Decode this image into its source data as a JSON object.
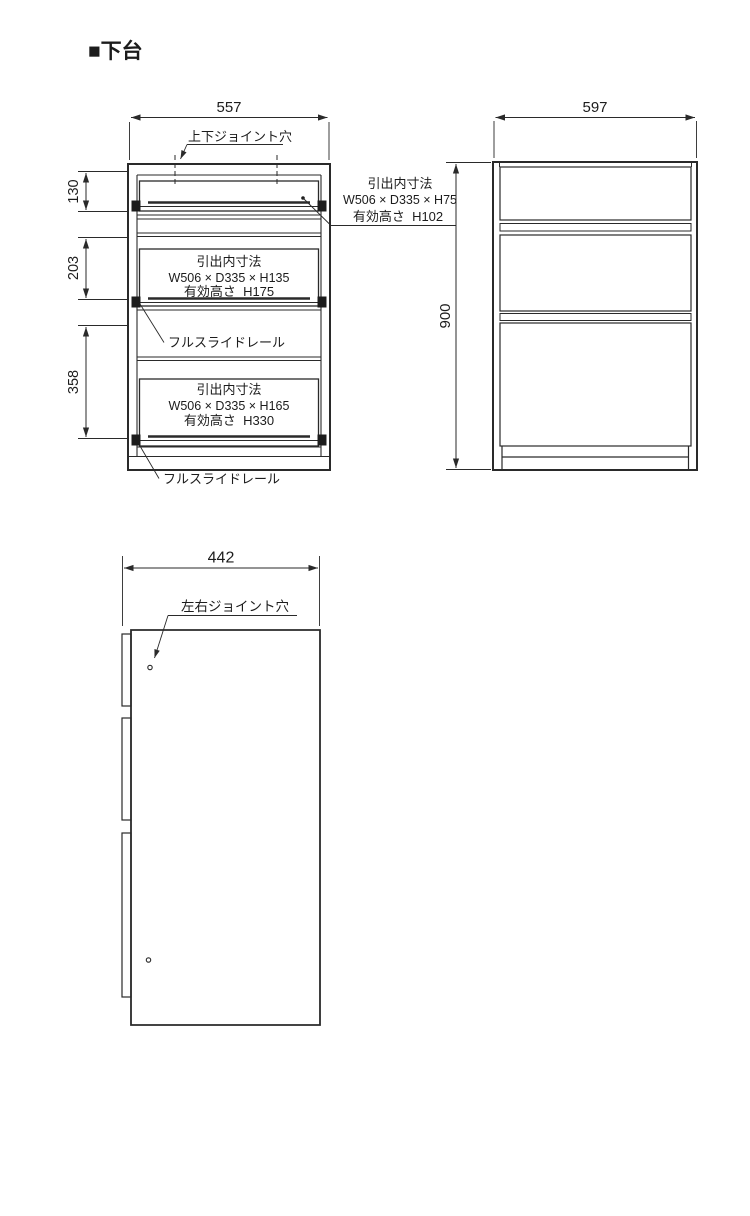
{
  "page": {
    "title": "■下台"
  },
  "front_view": {
    "width_dim": "557",
    "top_joint_label": "上下ジョイント穴",
    "height_dims": {
      "drawer1": "130",
      "drawer2": "203",
      "drawer3": "358"
    },
    "drawer1_note": {
      "line1": "引出内寸法",
      "line2": "W506 × D335 × H75",
      "line3": "有効高さ  H102"
    },
    "drawer2_note": {
      "line1": "引出内寸法",
      "line2": "W506 × D335 × H135",
      "line3": "有効高さ  H175"
    },
    "drawer3_note": {
      "line1": "引出内寸法",
      "line2": "W506 × D335 × H165",
      "line3": "有効高さ  H330"
    },
    "slide_rail_label_1": "フルスライドレール",
    "slide_rail_label_2": "フルスライドレール"
  },
  "side_view": {
    "width_dim": "597",
    "height_dim": "900"
  },
  "depth_view": {
    "width_dim": "442",
    "joint_label": "左右ジョイント穴"
  }
}
